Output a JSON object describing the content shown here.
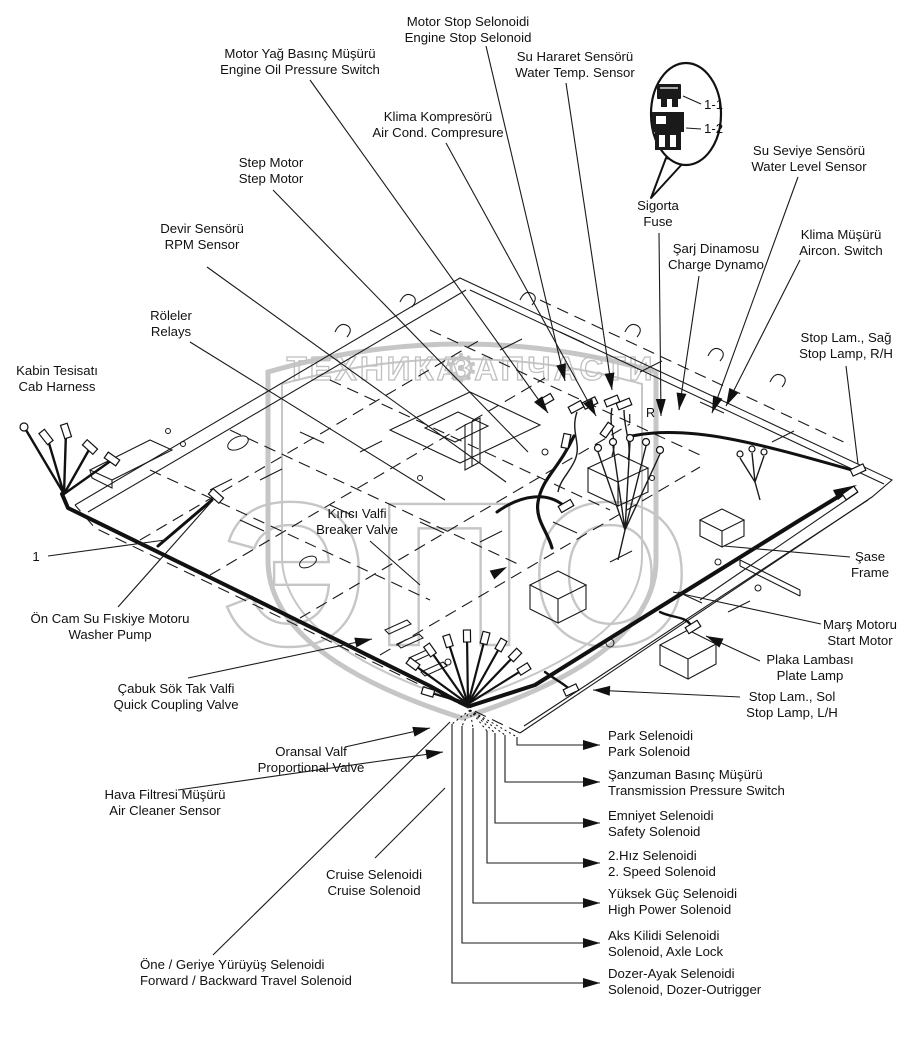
{
  "watermark": {
    "left": "ТЕХНИКА",
    "right": "ЗАПЧАСТИ",
    "big": "ЭПО",
    "gear": "⚙"
  },
  "callout": {
    "tag1": "1-1",
    "tag2": "1-2"
  },
  "diagram_marks": {
    "i": "I",
    "r": "R"
  },
  "labels": [
    {
      "id": "motor-stop-solenoid",
      "tr": "Motor Stop Selonoidi",
      "en": "Engine Stop Selonoid",
      "x": 468,
      "y": 26,
      "anchor": "middle",
      "leader": [
        [
          486,
          46
        ],
        [
          565,
          381
        ]
      ],
      "arrow": true
    },
    {
      "id": "engine-oil-pressure-switch",
      "tr": "Motor Yağ Basınç Müşürü",
      "en": "Engine Oil Pressure Switch",
      "x": 300,
      "y": 58,
      "anchor": "middle",
      "leader": [
        [
          310,
          80
        ],
        [
          548,
          413
        ]
      ],
      "arrow": true
    },
    {
      "id": "water-temp-sensor",
      "tr": "Su Hararet Sensörü",
      "en": "Water Temp. Sensor",
      "x": 575,
      "y": 61,
      "anchor": "middle",
      "leader": [
        [
          566,
          83
        ],
        [
          612,
          390
        ]
      ],
      "arrow": true
    },
    {
      "id": "ac-compressor",
      "tr": "Klima Kompresörü",
      "en": "Air Cond. Compresure",
      "x": 438,
      "y": 121,
      "anchor": "middle",
      "leader": [
        [
          446,
          143
        ],
        [
          596,
          416
        ]
      ],
      "arrow": true
    },
    {
      "id": "water-level-sensor",
      "tr": "Su Seviye Sensörü",
      "en": "Water Level Sensor",
      "x": 809,
      "y": 155,
      "anchor": "middle",
      "leader": [
        [
          798,
          177
        ],
        [
          712,
          413
        ]
      ],
      "arrow": true
    },
    {
      "id": "fuse",
      "tr": "Sigorta",
      "en": "Fuse",
      "x": 658,
      "y": 210,
      "anchor": "middle",
      "leader": [
        [
          659,
          233
        ],
        [
          661,
          416
        ]
      ],
      "arrow": true
    },
    {
      "id": "aircon-switch",
      "tr": "Klima Müşürü",
      "en": "Aircon. Switch",
      "x": 841,
      "y": 239,
      "anchor": "middle",
      "leader": [
        [
          800,
          260
        ],
        [
          726,
          406
        ]
      ],
      "arrow": true
    },
    {
      "id": "charge-dynamo",
      "tr": "Şarj Dinamosu",
      "en": "Charge Dynamo",
      "x": 716,
      "y": 253,
      "anchor": "middle",
      "leader": [
        [
          699,
          276
        ],
        [
          679,
          410
        ]
      ],
      "arrow": true
    },
    {
      "id": "step-motor",
      "tr": "Step Motor",
      "en": "Step Motor",
      "x": 271,
      "y": 167,
      "anchor": "middle",
      "leader": [
        [
          273,
          190
        ],
        [
          528,
          452
        ]
      ],
      "arrow": false
    },
    {
      "id": "rpm-sensor",
      "tr": "Devir Sensörü",
      "en": "RPM Sensor",
      "x": 202,
      "y": 233,
      "anchor": "middle",
      "leader": [
        [
          207,
          267
        ],
        [
          506,
          482
        ]
      ],
      "arrow": false
    },
    {
      "id": "relays",
      "tr": "Röleler",
      "en": "Relays",
      "x": 171,
      "y": 320,
      "anchor": "middle",
      "leader": [
        [
          190,
          342
        ],
        [
          445,
          500
        ]
      ],
      "arrow": false
    },
    {
      "id": "stop-lamp-rh",
      "tr": "Stop Lam., Sağ",
      "en": "Stop Lamp, R/H",
      "x": 846,
      "y": 342,
      "anchor": "middle",
      "leader": [
        [
          846,
          366
        ],
        [
          858,
          464
        ]
      ],
      "arrow": false
    },
    {
      "id": "cab-harness",
      "tr": "Kabin Tesisatı",
      "en": "Cab Harness",
      "x": 57,
      "y": 375,
      "anchor": "middle",
      "leader": null,
      "arrow": false
    },
    {
      "id": "item-1",
      "tr": "1",
      "en": "",
      "x": 36,
      "y": 561,
      "anchor": "middle",
      "leader": [
        [
          48,
          556
        ],
        [
          165,
          540
        ]
      ],
      "arrow": false
    },
    {
      "id": "breaker-valve",
      "tr": "Kırıcı Valfi",
      "en": "Breaker Valve",
      "x": 357,
      "y": 518,
      "anchor": "middle",
      "leader": [
        [
          370,
          541
        ],
        [
          420,
          585
        ]
      ],
      "arrow": false
    },
    {
      "id": "frame",
      "tr": "Şase",
      "en": "Frame",
      "x": 870,
      "y": 561,
      "anchor": "middle",
      "leader": [
        [
          850,
          557
        ],
        [
          724,
          546
        ]
      ],
      "arrow": false
    },
    {
      "id": "washer-pump",
      "tr": "Ön Cam Su Fıskiye Motoru",
      "en": "Washer Pump",
      "x": 110,
      "y": 623,
      "anchor": "middle",
      "leader": [
        [
          118,
          607
        ],
        [
          213,
          500
        ]
      ],
      "arrow": false
    },
    {
      "id": "start-motor",
      "tr": "Marş Motoru",
      "en": "Start Motor",
      "x": 860,
      "y": 629,
      "anchor": "middle",
      "leader": [
        [
          821,
          624
        ],
        [
          673,
          592
        ]
      ],
      "arrow": false
    },
    {
      "id": "plate-lamp",
      "tr": "Plaka Lambası",
      "en": "Plate Lamp",
      "x": 810,
      "y": 664,
      "anchor": "middle",
      "leader": [
        [
          760,
          661
        ],
        [
          706,
          636
        ]
      ],
      "arrow": true
    },
    {
      "id": "quick-coupling-valve",
      "tr": "Çabuk Sök Tak Valfi",
      "en": "Quick Coupling Valve",
      "x": 176,
      "y": 693,
      "anchor": "middle",
      "leader": [
        [
          188,
          678
        ],
        [
          372,
          639
        ]
      ],
      "arrow": true
    },
    {
      "id": "stop-lamp-lh",
      "tr": "Stop Lam., Sol",
      "en": "Stop Lamp, L/H",
      "x": 792,
      "y": 701,
      "anchor": "middle",
      "leader": [
        [
          740,
          697
        ],
        [
          593,
          690
        ]
      ],
      "arrow": true
    },
    {
      "id": "park-solenoid",
      "tr": "Park Selenoidi",
      "en": "Park Solenoid",
      "x": 608,
      "y": 740,
      "anchor": "start",
      "leader": [
        [
          517,
          737
        ],
        [
          517,
          745
        ],
        [
          600,
          745
        ]
      ],
      "arrow": true
    },
    {
      "id": "proportional-valve",
      "tr": "Oransal Valf",
      "en": "Proportional Valve",
      "x": 311,
      "y": 756,
      "anchor": "middle",
      "leader": [
        [
          345,
          747
        ],
        [
          430,
          728
        ]
      ],
      "arrow": true
    },
    {
      "id": "transmission-pressure-switch",
      "tr": "Şanzuman Basınç Müşürü",
      "en": "Transmission Pressure Switch",
      "x": 608,
      "y": 779,
      "anchor": "start",
      "leader": [
        [
          505,
          735
        ],
        [
          505,
          782
        ],
        [
          600,
          782
        ]
      ],
      "arrow": true
    },
    {
      "id": "air-cleaner-sensor",
      "tr": "Hava Filtresi Müşürü",
      "en": "Air Cleaner Sensor",
      "x": 165,
      "y": 799,
      "anchor": "middle",
      "leader": [
        [
          178,
          790
        ],
        [
          443,
          752
        ]
      ],
      "arrow": true
    },
    {
      "id": "safety-solenoid",
      "tr": "Emniyet Selenoidi",
      "en": "Safety Solenoid",
      "x": 608,
      "y": 820,
      "anchor": "start",
      "leader": [
        [
          495,
          733
        ],
        [
          495,
          823
        ],
        [
          600,
          823
        ]
      ],
      "arrow": true
    },
    {
      "id": "speed2-solenoid",
      "tr": "2.Hız Selenoidi",
      "en": "2. Speed Solenoid",
      "x": 608,
      "y": 860,
      "anchor": "start",
      "leader": [
        [
          487,
          731
        ],
        [
          487,
          863
        ],
        [
          600,
          863
        ]
      ],
      "arrow": true
    },
    {
      "id": "cruise-solenoid",
      "tr": "Cruise Selenoidi",
      "en": "Cruise Solenoid",
      "x": 374,
      "y": 879,
      "anchor": "middle",
      "leader": [
        [
          375,
          858
        ],
        [
          445,
          788
        ]
      ],
      "arrow": false
    },
    {
      "id": "high-power-solenoid",
      "tr": "Yüksek Güç Selenoidi",
      "en": "High Power Solenoid",
      "x": 608,
      "y": 898,
      "anchor": "start",
      "leader": [
        [
          473,
          728
        ],
        [
          473,
          903
        ],
        [
          600,
          903
        ]
      ],
      "arrow": true
    },
    {
      "id": "axle-lock-solenoid",
      "tr": "Aks Kilidi Selenoidi",
      "en": "Solenoid, Axle Lock",
      "x": 608,
      "y": 940,
      "anchor": "start",
      "leader": [
        [
          462,
          726
        ],
        [
          462,
          943
        ],
        [
          600,
          943
        ]
      ],
      "arrow": true
    },
    {
      "id": "fwd-bwd-travel-solenoid",
      "tr": "Öne / Geriye Yürüyüş Selenoidi",
      "en": "Forward / Backward Travel Solenoid",
      "x": 140,
      "y": 969,
      "anchor": "start",
      "leader": [
        [
          213,
          955
        ],
        [
          450,
          722
        ]
      ],
      "arrow": false
    },
    {
      "id": "dozer-outrigger-solenoid",
      "tr": "Dozer-Ayak Selenoidi",
      "en": "Solenoid, Dozer-Outrigger",
      "x": 608,
      "y": 978,
      "anchor": "start",
      "leader": [
        [
          452,
          724
        ],
        [
          452,
          983
        ],
        [
          600,
          983
        ]
      ],
      "arrow": true
    }
  ]
}
